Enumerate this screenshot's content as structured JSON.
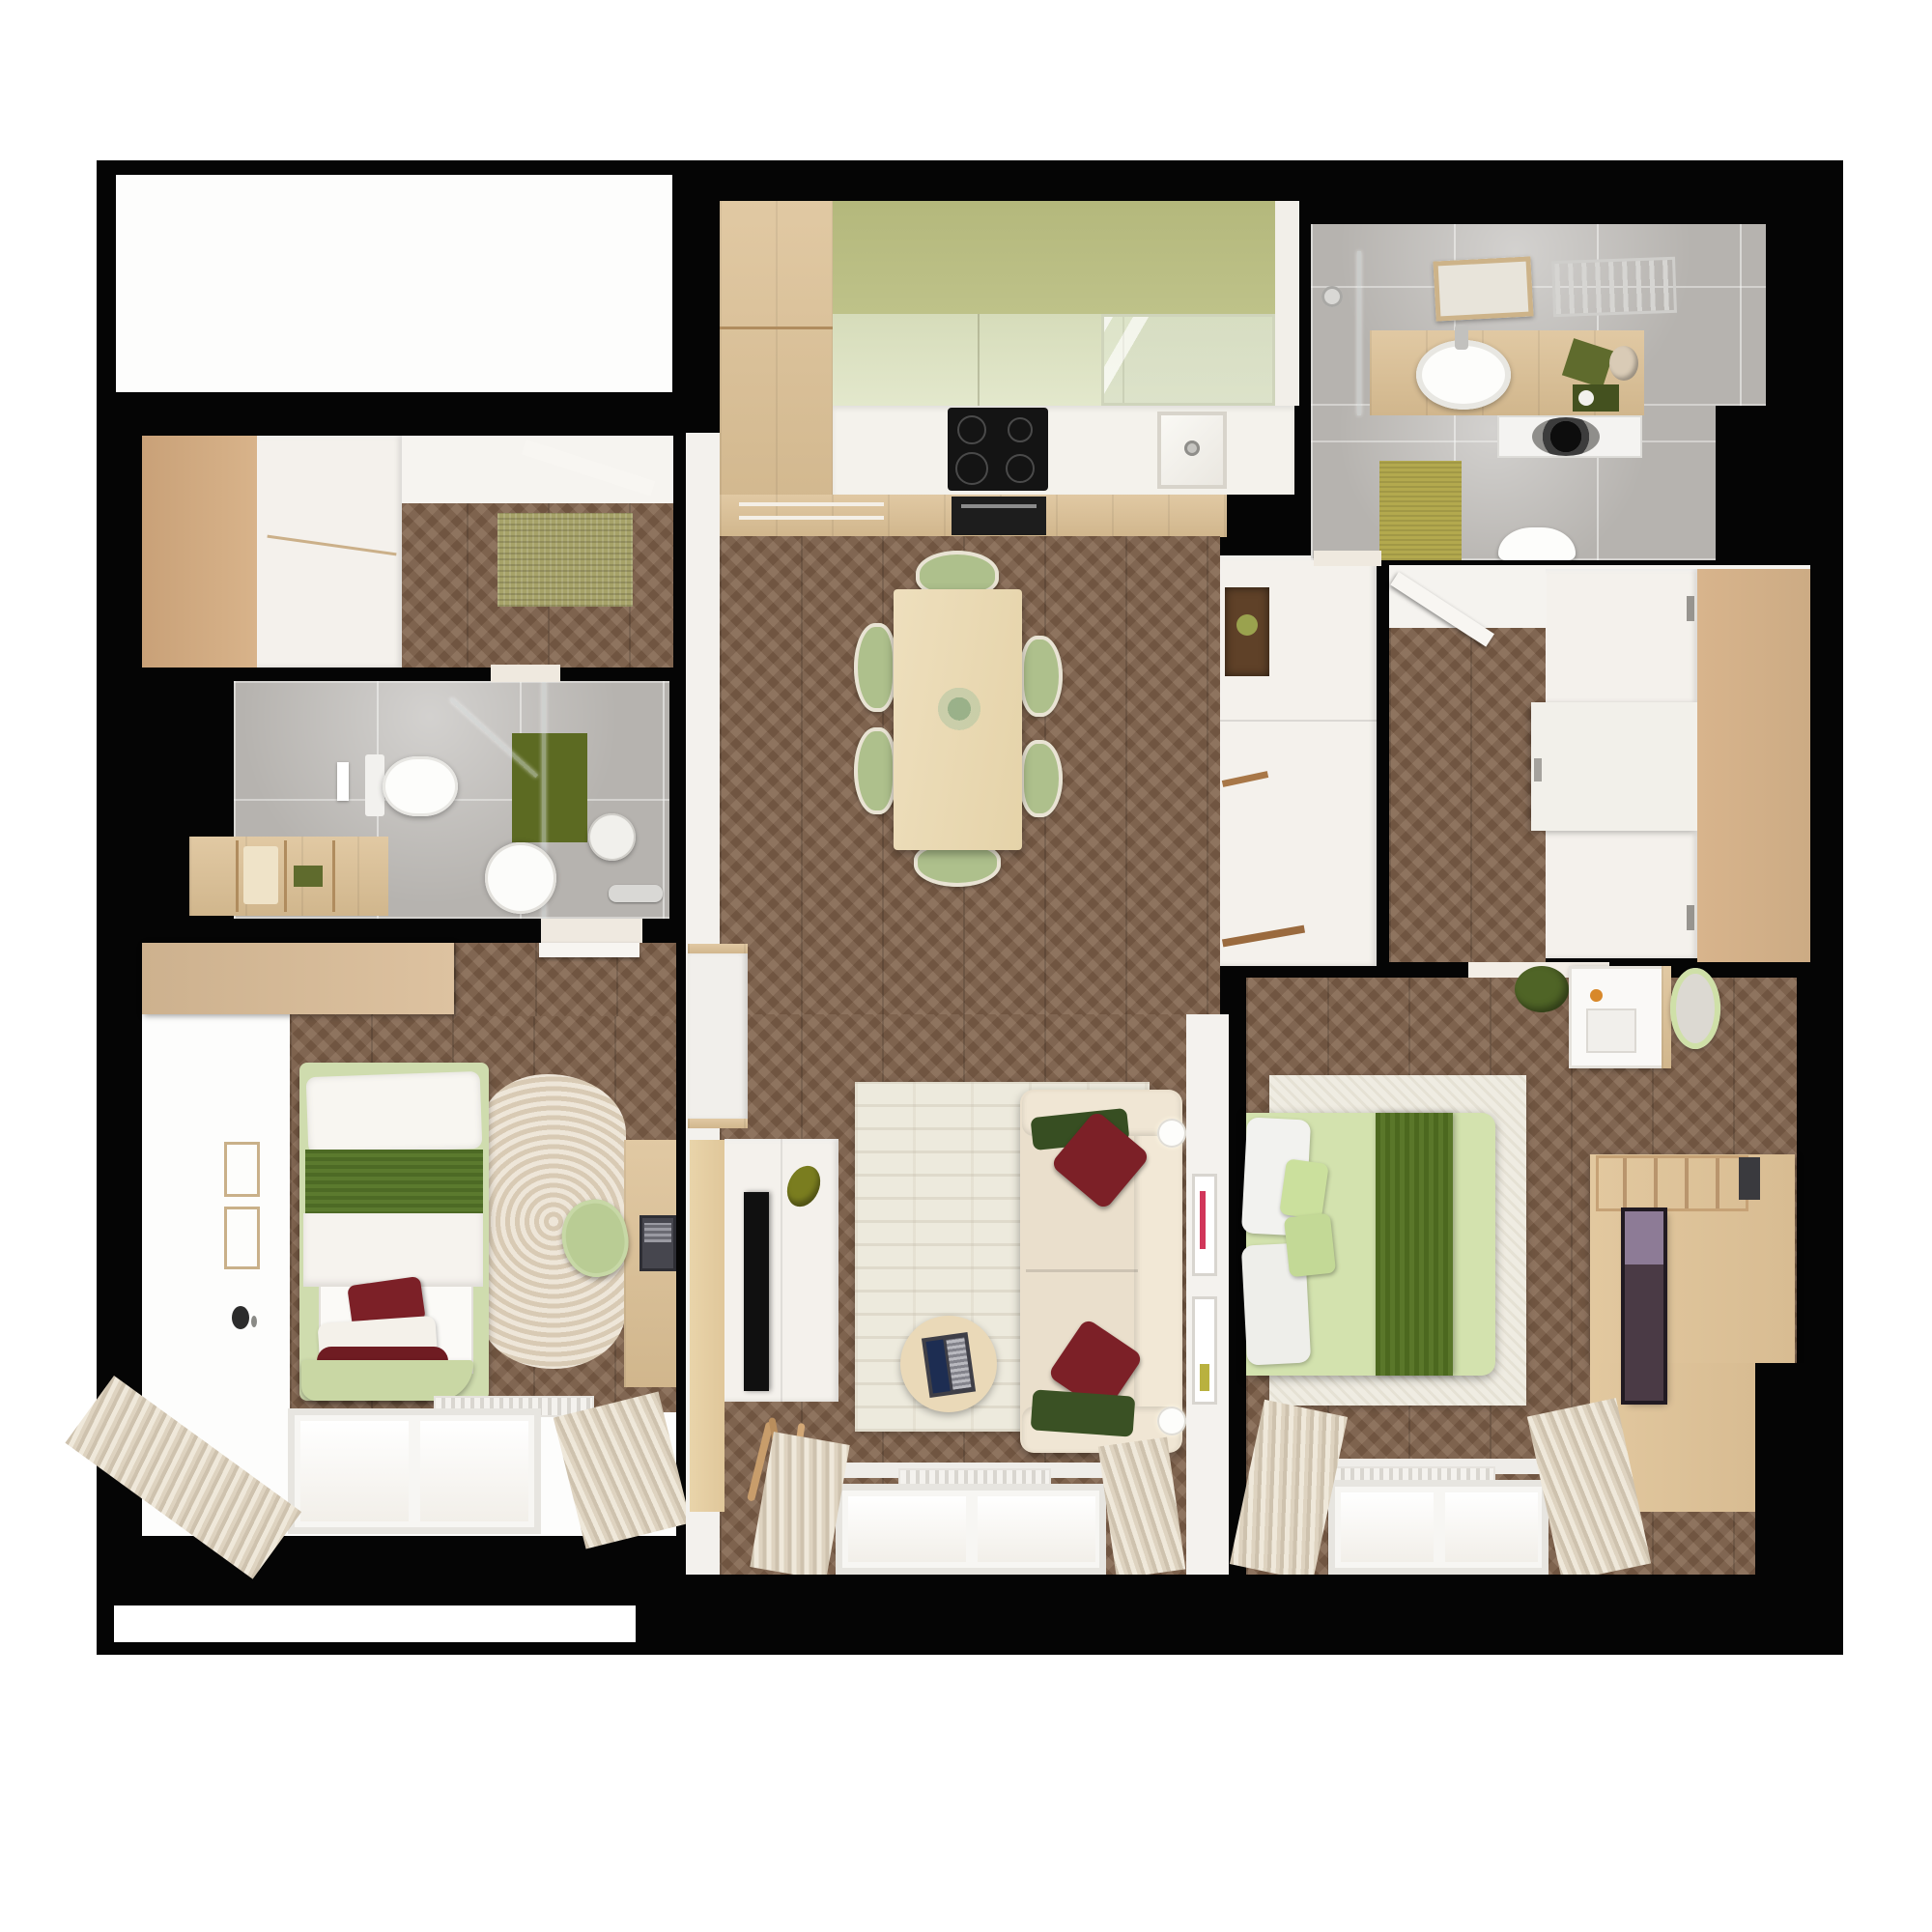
{
  "image_type": "top-down 3D rendered apartment floor plan, no visible text",
  "palette": {
    "structure_wall": "#050505",
    "page_background": "#ffffff",
    "wood_floor": "#80614a",
    "wood_light": "#dcc094",
    "kitchen_cabinet_olive": "#b9bd82",
    "kitchen_cabinet_sage": "#dde2c4",
    "bathroom_tile_grey": "#b6b3af",
    "accent_olive_panel": "#5c6a22",
    "bathroom_rug_olive": "#b3a94e",
    "kid_bed_green": "#4d6a25",
    "master_duvet_green": "#d3e2ae",
    "master_runner_green": "#4c681f",
    "pillow_red": "#7c2027",
    "sofa_beige": "#eadfcc",
    "wardrobe_tan": "#d3ae86",
    "living_rug_cream": "#edeadd"
  },
  "rooms": [
    {
      "name": "utility-room",
      "furniture": []
    },
    {
      "name": "hallway-closet",
      "furniture": [
        "built-in-wardrobe",
        "woven-rug"
      ]
    },
    {
      "name": "bathroom-small",
      "furniture": [
        "toilet",
        "shower",
        "shelf-unit",
        "round-mirror",
        "olive-accent-panel"
      ]
    },
    {
      "name": "kids-bedroom",
      "furniture": [
        "single-bed",
        "red-pillows",
        "cloud-rug",
        "desk",
        "laptop",
        "desk-chair",
        "wardrobe",
        "wall-lamp",
        "picture-frames",
        "radiator",
        "window",
        "curtains"
      ]
    },
    {
      "name": "kitchen-dining",
      "furniture": [
        "tall-cabinet",
        "upper-cabinets",
        "glass-cabinet",
        "countertop",
        "induction-hob",
        "oven",
        "sink",
        "dining-table",
        "plant-centerpiece",
        "six-green-chairs",
        "sideboard",
        "radiator-console"
      ]
    },
    {
      "name": "living-room",
      "furniture": [
        "tv-cabinet",
        "tv",
        "bottle-vase",
        "driftwood-decor",
        "rug",
        "round-coffee-table",
        "laptop",
        "sofa",
        "green-pillows",
        "red-pillows",
        "wall-sconces",
        "picture-frames",
        "radiator",
        "window",
        "curtains"
      ]
    },
    {
      "name": "bathroom-main",
      "furniture": [
        "shower",
        "vanity-counter",
        "sink",
        "mirror",
        "towel-radiator",
        "washing-machine",
        "toilet",
        "olive-rug"
      ]
    },
    {
      "name": "walk-in-closet",
      "furniture": [
        "sliding-door-wardrobe",
        "open-door"
      ]
    },
    {
      "name": "master-bedroom",
      "furniture": [
        "double-bed",
        "green-runner",
        "pillows",
        "white-rug",
        "dressing-table",
        "round-mirror",
        "green-stool",
        "wood-media-panel",
        "radiator",
        "window",
        "curtains"
      ]
    }
  ]
}
